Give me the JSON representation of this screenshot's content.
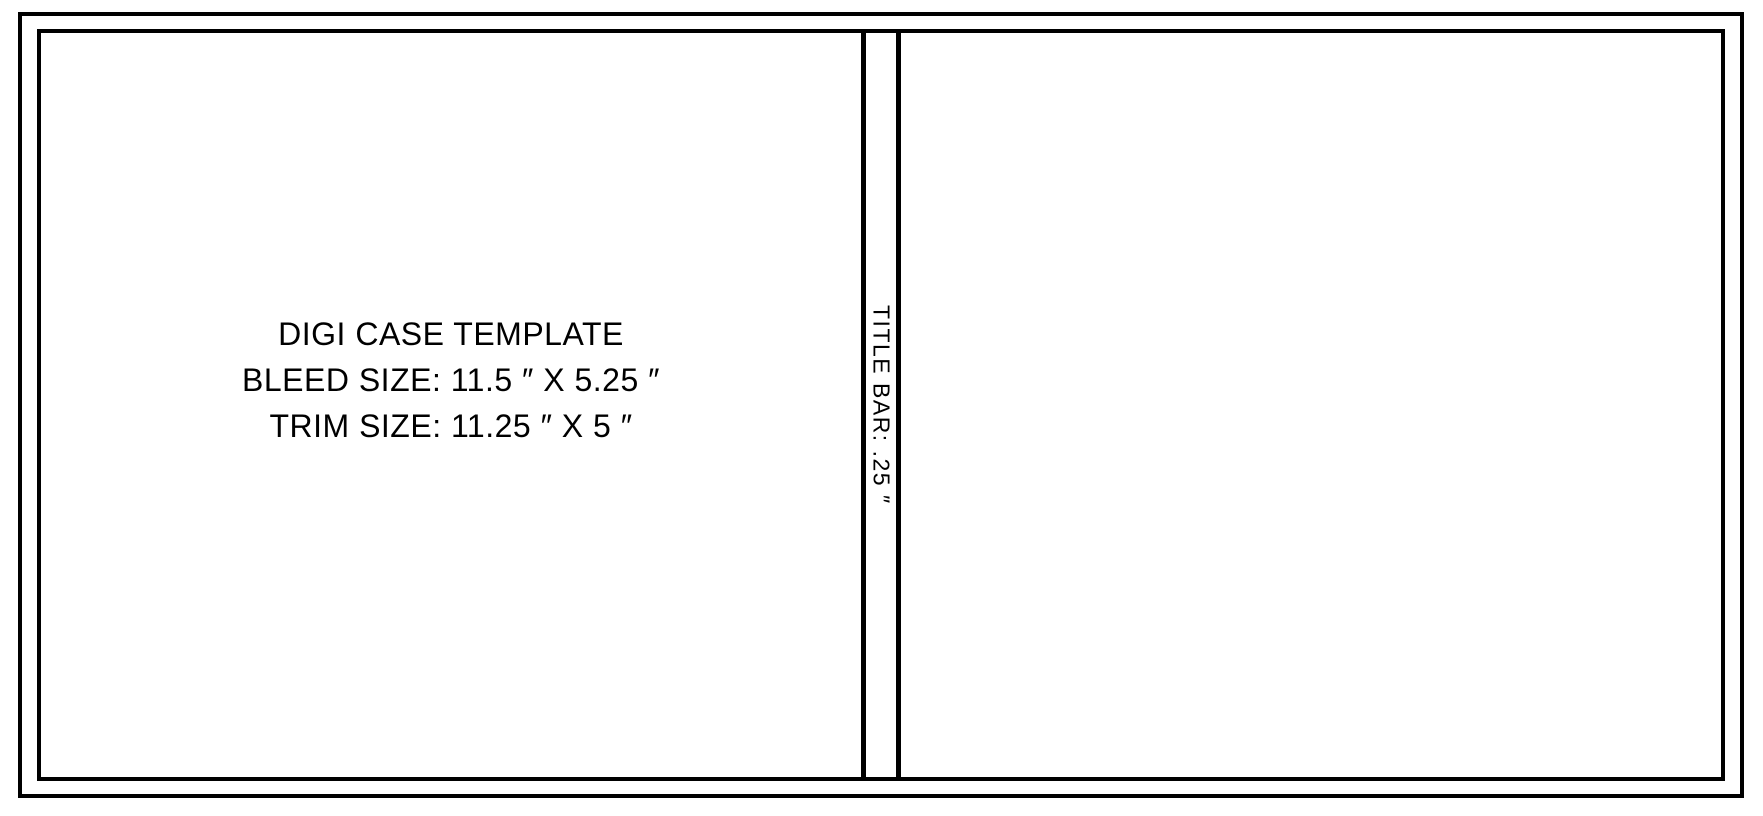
{
  "template": {
    "info": {
      "line1": "DIGI CASE TEMPLATE",
      "line2": "BLEED SIZE: 11.5 ″ X 5.25 ″",
      "line3": "TRIM SIZE: 11.25 ″ X 5 ″"
    },
    "title_bar": {
      "label": "TITLE BAR: .25 ″"
    },
    "colors": {
      "line": "#000000",
      "background": "#ffffff"
    }
  }
}
